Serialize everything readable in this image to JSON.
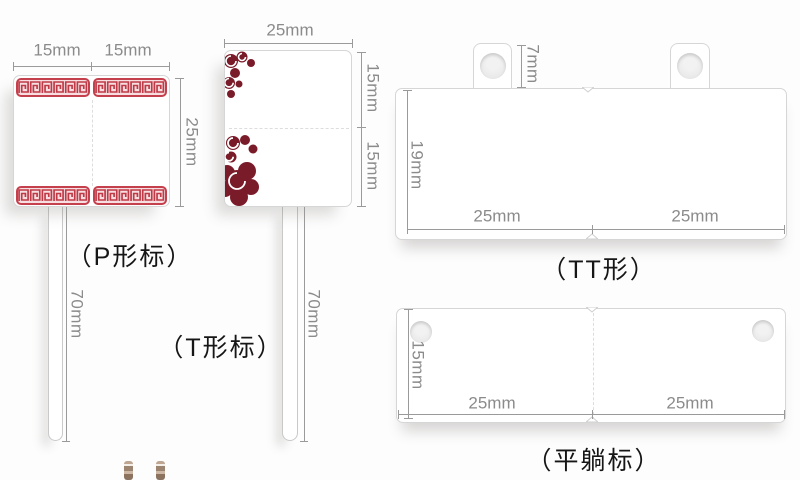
{
  "colors": {
    "dimension_text": "#8b8b8b",
    "dimension_line": "#9a9a9a",
    "tag_border": "#d6d6d6",
    "meander_red": "#c5404d",
    "meander_fill": "#f7dfe1",
    "floral_maroon": "#7a1b2a",
    "label_text": "#161616"
  },
  "p_tag": {
    "label": "（P形标）",
    "dim_width_left": "15mm",
    "dim_width_right": "15mm",
    "dim_height": "25mm",
    "dim_stem": "70mm"
  },
  "t_tag": {
    "label": "（T形标）",
    "dim_width": "25mm",
    "dim_height_top": "15mm",
    "dim_height_bottom": "15mm",
    "dim_stem": "70mm"
  },
  "tt_tag": {
    "label": "（TT形）",
    "dim_tab_height": "7mm",
    "dim_height": "19mm",
    "dim_width_left": "25mm",
    "dim_width_right": "25mm"
  },
  "flat_tag": {
    "label": "（平躺标）",
    "dim_height": "15mm",
    "dim_width_left": "25mm",
    "dim_width_right": "25mm"
  }
}
